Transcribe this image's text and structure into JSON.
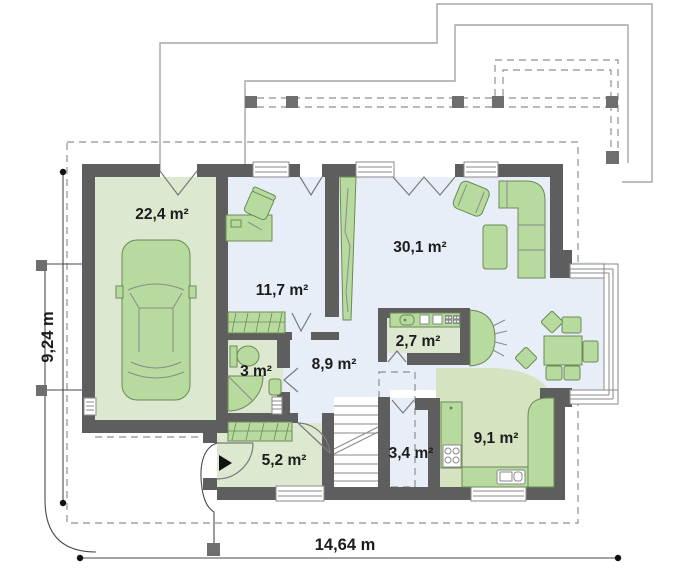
{
  "plan": {
    "rooms": {
      "garage": "22,4 m²",
      "office": "11,7 m²",
      "living": "30,1 m²",
      "pantry": "2,7 m²",
      "hall": "8,9 m²",
      "bathroom": "3 m²",
      "entry": "5,2 m²",
      "corridor": "3,4 m²",
      "kitchen": "9,1 m²"
    },
    "dimensions": {
      "width": "14,64 m",
      "depth": "9,24 m"
    }
  },
  "colors": {
    "wall": "#5e5e5e",
    "floor_blue": "#e8eef7",
    "floor_green": "#dce8d0",
    "kitchen_green": "#d5e3c0",
    "furniture": "#b7db9e",
    "furniture_stroke": "#6b8a54",
    "line_thin": "#a6a6a6",
    "dash": "#8f8f8f",
    "door": "#7a7a7a",
    "ink": "#1c1c1c"
  }
}
